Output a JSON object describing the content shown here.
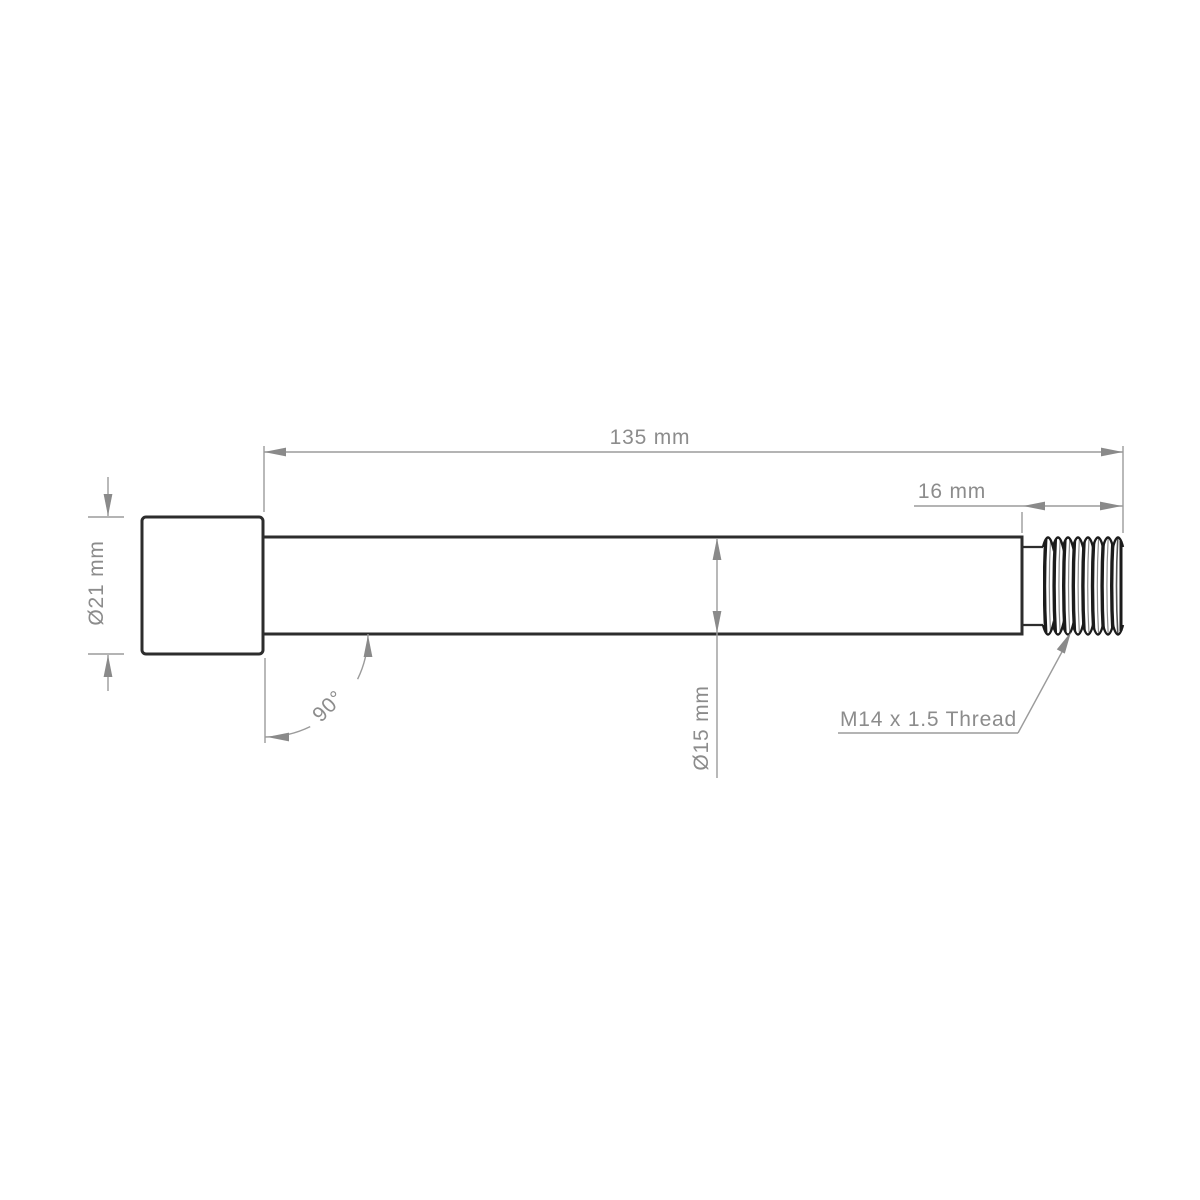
{
  "drawing": {
    "kind": "technical-dimension-drawing",
    "subject": "threaded axle bolt, side profile view",
    "dimensions": {
      "overall_length": {
        "label": "135 mm",
        "value": 135,
        "unit": "mm"
      },
      "thread_length": {
        "label": "16 mm",
        "value": 16,
        "unit": "mm"
      },
      "head_diameter": {
        "label": "Ø21 mm",
        "value": 21,
        "unit": "mm"
      },
      "shaft_diameter": {
        "label": "Ø15 mm",
        "value": 15,
        "unit": "mm"
      },
      "shoulder_angle": {
        "label": "90°",
        "value": 90,
        "unit": "degrees"
      },
      "thread_spec": {
        "label": "M14 x 1.5 Thread"
      }
    },
    "colors": {
      "part_outline": "#2d2d2d",
      "dimension_lines": "#9b9b9b",
      "dimension_text": "#8c8c8c",
      "thread_dark": "#1b1b1b",
      "background": "#ffffff"
    }
  }
}
